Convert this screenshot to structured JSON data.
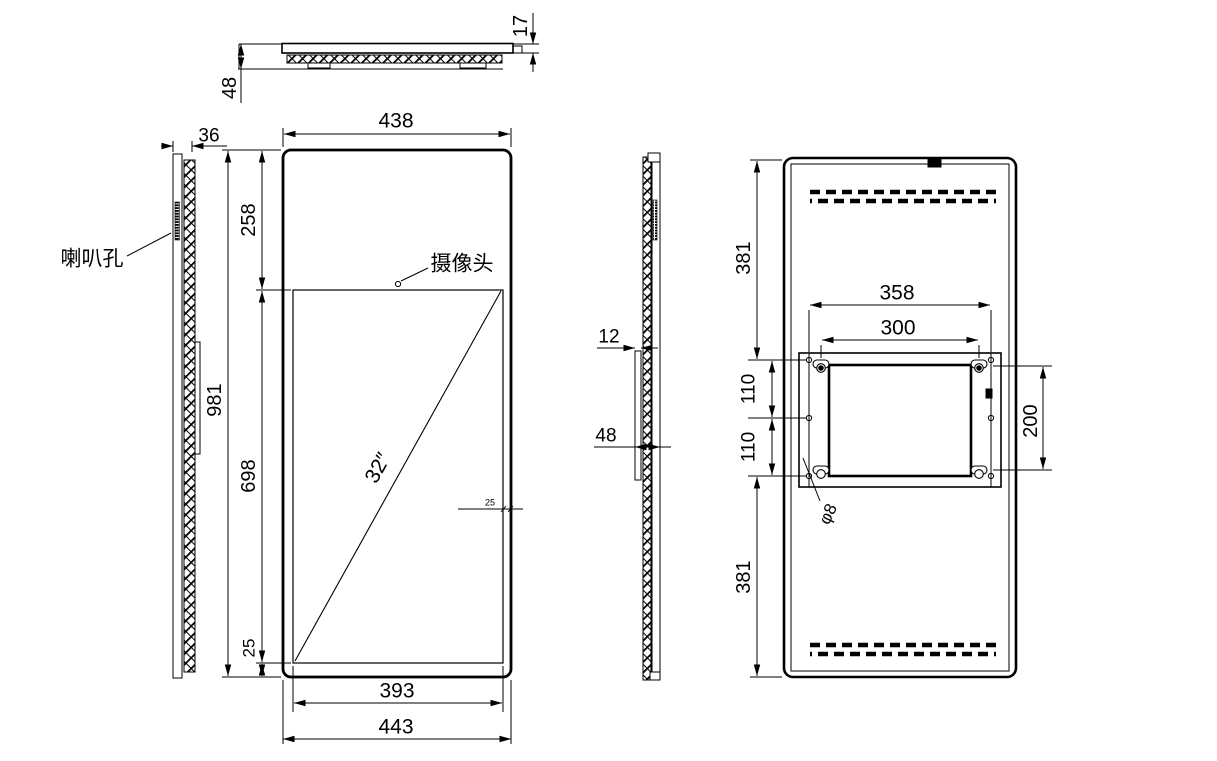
{
  "views": {
    "top": {
      "dim_depth": "48",
      "dim_front_thickness": "17"
    },
    "left_side": {
      "dim_thickness": "36",
      "label_speaker_holes": "喇叭孔"
    },
    "front": {
      "dim_width_top": "438",
      "dim_top_margin": "258",
      "dim_height": "981",
      "dim_screen_height": "698",
      "dim_bottom_margin": "25",
      "dim_side_margin": "25",
      "dim_screen_width": "393",
      "dim_width_bottom": "443",
      "label_camera": "摄像头",
      "label_screen_size": "32″"
    },
    "right_side": {
      "dim_plate_thickness": "12",
      "dim_depth": "48"
    },
    "back": {
      "dim_top_section": "381",
      "dim_hole_spacing_upper": "110",
      "dim_hole_spacing_lower": "110",
      "dim_bottom_section": "381",
      "dim_bracket_width": "358",
      "dim_vesa_width": "300",
      "dim_vesa_height": "200",
      "label_hole_diameter": "φ8"
    }
  }
}
